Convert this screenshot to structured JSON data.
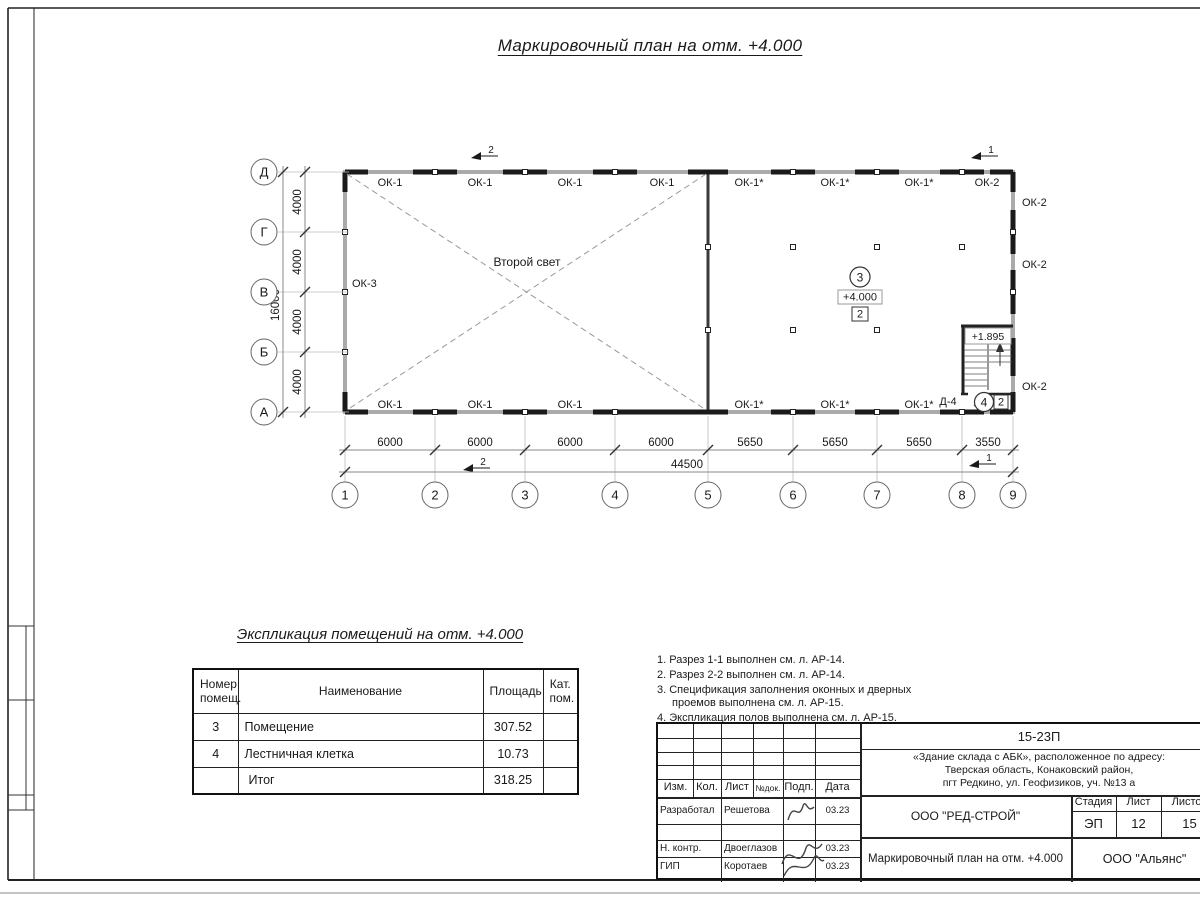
{
  "page_title": "Маркировочный план на отм. +4.000",
  "plan": {
    "second_light": "Второй свет",
    "axes_rows": [
      "Д",
      "Г",
      "В",
      "Б",
      "А"
    ],
    "axes_cols": [
      "1",
      "2",
      "3",
      "4",
      "5",
      "6",
      "7",
      "8",
      "9"
    ],
    "dims_left": [
      "4000",
      "4000",
      "4000",
      "4000"
    ],
    "dim_left_total": "16000",
    "dims_bottom": [
      "6000",
      "6000",
      "6000",
      "6000",
      "5650",
      "5650",
      "5650",
      "3550"
    ],
    "dim_bottom_total": "44500",
    "windows_top": [
      "ОК-1",
      "ОК-1",
      "ОК-1",
      "ОК-1",
      "ОК-1*",
      "ОК-1*",
      "ОК-1*",
      "ОК-2"
    ],
    "windows_bottom": [
      "ОК-1",
      "ОК-1",
      "ОК-1",
      "ОК-1*",
      "ОК-1*",
      "ОК-1*"
    ],
    "windows_right": [
      "ОК-2",
      "ОК-2",
      "ОК-2"
    ],
    "window_left": "ОК-3",
    "section_marks": {
      "top_left": "2",
      "top_right": "1",
      "bottom_left": "2",
      "bottom_right": "1"
    },
    "room3": {
      "number": "3",
      "elevation": "+4.000",
      "category": "2"
    },
    "stair": {
      "elevation": "+1.895",
      "door": "Д-4",
      "number": "4",
      "category": "2"
    }
  },
  "explication": {
    "title": "Экспликация помещений на отм. +4.000",
    "headers": [
      "Номер помещ.",
      "Наименование",
      "Площадь",
      "Кат. пом."
    ],
    "rows": [
      {
        "num": "3",
        "name": "Помещение",
        "area": "307.52",
        "cat": ""
      },
      {
        "num": "4",
        "name": "Лестничная клетка",
        "area": "10.73",
        "cat": ""
      },
      {
        "num": "",
        "name": "Итог",
        "area": "318.25",
        "cat": ""
      }
    ]
  },
  "notes": [
    "1. Разрез 1-1 выполнен см. л. АР-14.",
    "2. Разрез 2-2 выполнен см. л. АР-14.",
    "3. Спецификация заполнения оконных и дверных проемов выполнена см. л. АР-15.",
    "4. Экспликация полов выполнена см. л. АР-15."
  ],
  "titleblock": {
    "doc_number": "15-23П",
    "object_line1": "«Здание склада с АБК», расположенное по адресу:",
    "object_line2": "Тверская область, Конаковский район,",
    "object_line3": "пгт Редкино, ул. Геофизиков, уч. №13 а",
    "header_cols": [
      "Изм.",
      "Кол.",
      "Лист",
      "№док.",
      "Подп.",
      "Дата"
    ],
    "company": "ООО \"РЕД-СТРОЙ\"",
    "stage_label": "Стадия",
    "sheet_label": "Лист",
    "sheets_label": "Листов",
    "stage": "ЭП",
    "sheet": "12",
    "sheets": "15",
    "drawing_title": "Маркировочный план на отм. +4.000",
    "contractor": "ООО \"Альянс\"",
    "people": [
      {
        "role": "Разработал",
        "name": "Решетова",
        "date": "03.23"
      },
      {
        "role": "Н. контр.",
        "name": "Двоеглазов",
        "date": "03.23"
      },
      {
        "role": "ГИП",
        "name": "Коротаев",
        "date": "03.23"
      }
    ]
  }
}
